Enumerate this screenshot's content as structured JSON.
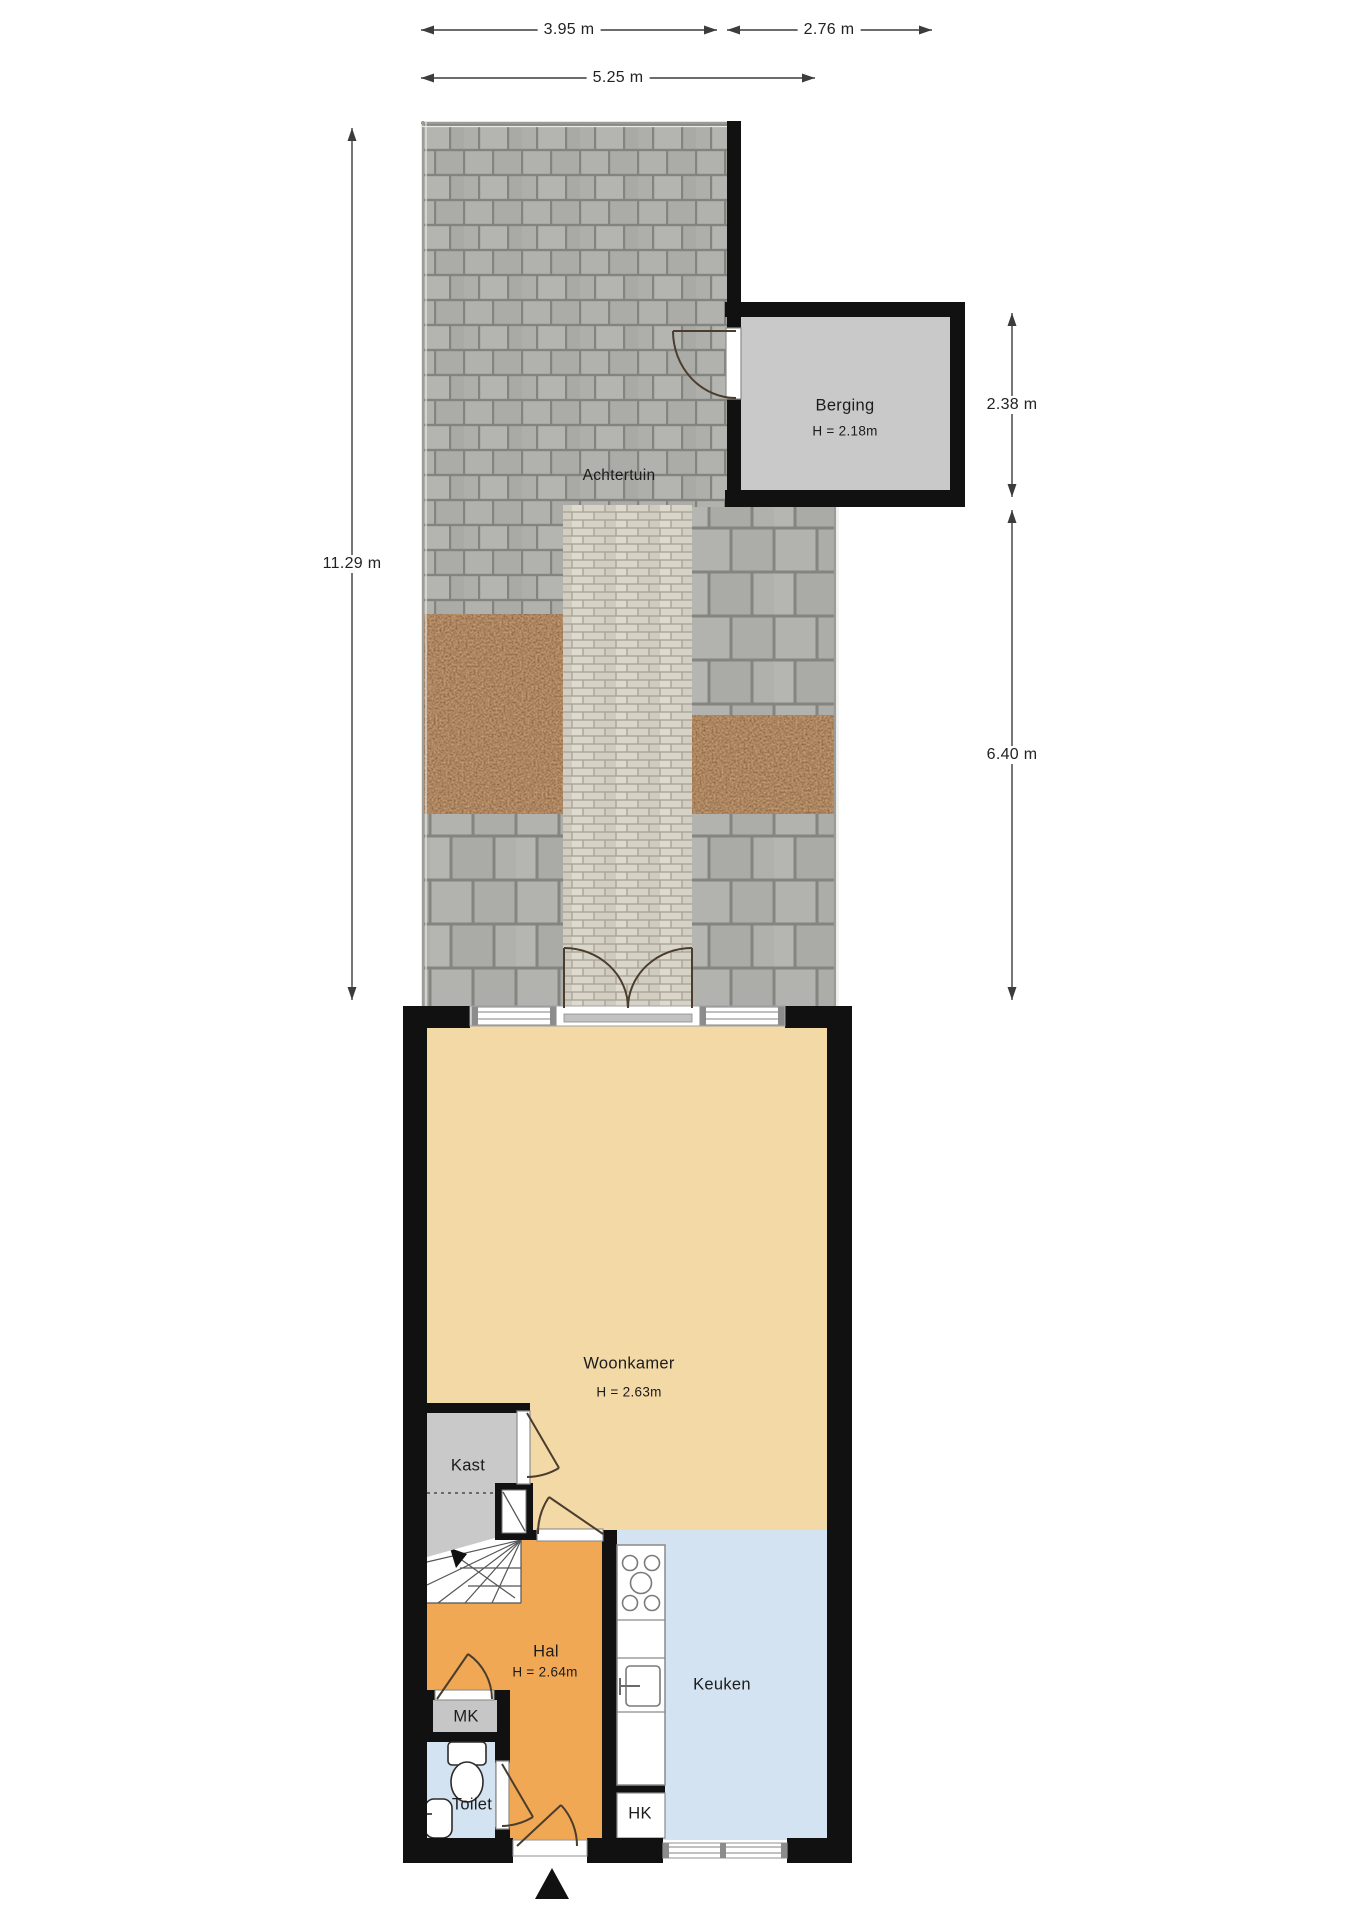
{
  "plan": {
    "garden_label": "Achtertuin",
    "rooms": {
      "berging": {
        "name": "Berging",
        "height": "H = 2.18m"
      },
      "woonkamer": {
        "name": "Woonkamer",
        "height": "H = 2.63m"
      },
      "kast": {
        "name": "Kast"
      },
      "hal": {
        "name": "Hal",
        "height": "H = 2.64m"
      },
      "mk": {
        "name": "MK"
      },
      "toilet": {
        "name": "Toilet"
      },
      "keuken": {
        "name": "Keuken"
      },
      "hk": {
        "name": "HK"
      }
    },
    "dimensions": {
      "top_left": "3.95 m",
      "top_right": "2.76 m",
      "top_total": "5.25 m",
      "left_total": "11.29 m",
      "right_upper": "2.38 m",
      "right_lower": "6.40 m"
    },
    "colors": {
      "wall": "#111111",
      "woonkamer": "#f2d9a6",
      "hal": "#f1a854",
      "keuken": "#d4e3f1",
      "toilet": "#d4e3f1",
      "berging": "#c9c9c9",
      "kast": "#c9c9c9",
      "mk": "#c6c6c6",
      "tile": "#b0b1ad",
      "brick": "#d8d4c7",
      "soil": "#4a2b18",
      "dimension_line": "#3c3c3c"
    }
  }
}
